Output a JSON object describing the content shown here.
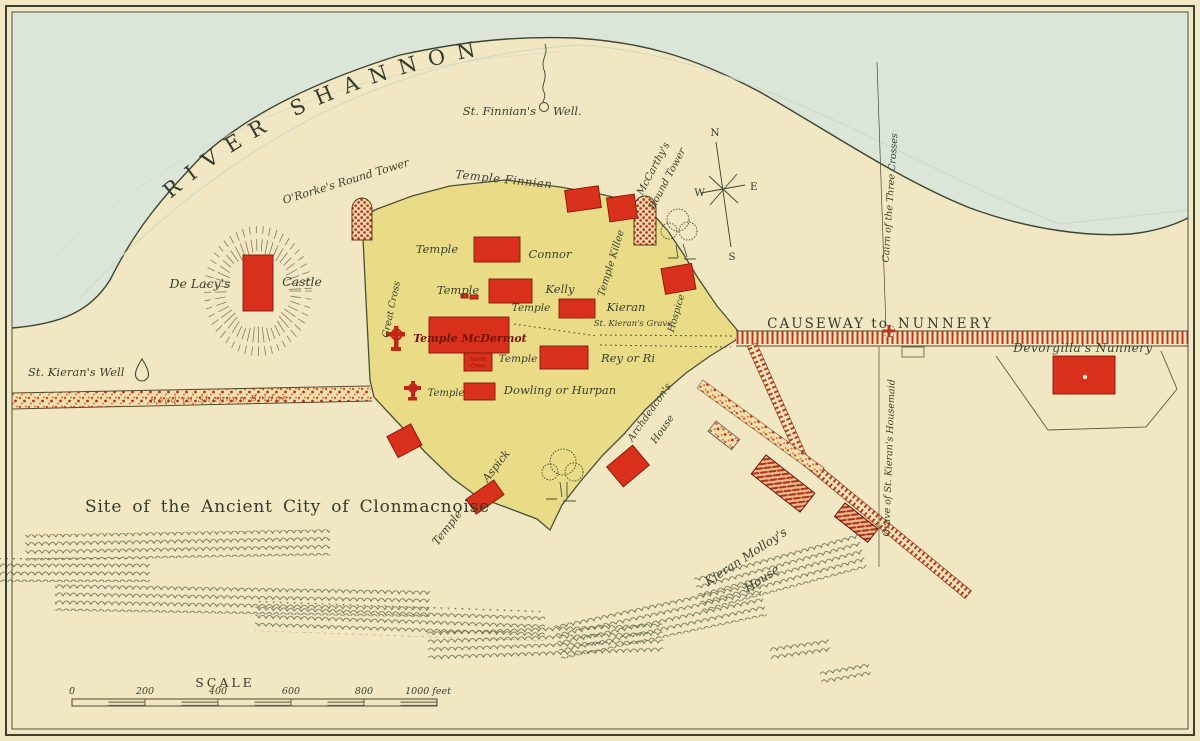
{
  "map": {
    "labels": {
      "river": "RIVER SHANNON",
      "finnians_well_a": "St. Finnian's",
      "finnians_well_b": "Well.",
      "ororkes_tower": "O'Rorke's Round Tower",
      "temple_finnian": "Temple Finnian",
      "mccarthys_tower_1": "McCarthy's",
      "mccarthys_tower_2": "Round Tower",
      "de_lacys": "De Lacy's",
      "castle": "Castle",
      "great_cross": "Great Cross",
      "temple_connor_a": "Temple",
      "temple_connor_b": "Connor",
      "temple_kelly_a": "Temple",
      "temple_kelly_b": "Kelly",
      "temple_kieran_a": "Temple",
      "temple_kieran_b": "Kieran",
      "st_kierans_grave": "St. Kieran's Grave",
      "temple_killee": "Temple Killee",
      "hospice": "Hospice",
      "temple_mcdermot": "Temple McDermot",
      "north_cross_a": "North",
      "north_cross_b": "Cross",
      "temple_rey_a": "Temple",
      "temple_rey_b": "Rey or Ri",
      "temple_dowling_a": "Temple",
      "temple_dowling_b": "Dowling or Hurpan",
      "temple_aspick_a": "Temple",
      "temple_aspick_b": "Aspick",
      "archdeacons_house_a": "Archdeacon's",
      "archdeacons_house_b": "House",
      "causeway_a": "CAUSEWAY to",
      "causeway_b": "NUNNERY",
      "cairn": "Cairn of the Three Crosses",
      "housemaid_grave": "Grave of St. Kieran's Housemaid",
      "devorgillas_nunnery": "Devorgilla's Nunnery",
      "kieran_molloys_a": "Kieran Molloy's",
      "kieran_molloys_b": "House",
      "st_kierans_well": "St. Kieran's Well",
      "old_road": "Road to Shannon Bridge",
      "site_title": "Site of the Ancient City of Clonmacnoise"
    },
    "compass": {
      "n": "N",
      "e": "E",
      "s": "S",
      "w": "W"
    },
    "scale": {
      "title": "SCALE",
      "ticks": [
        "0",
        "200",
        "400",
        "600",
        "800"
      ],
      "end_label": "1000 feet"
    },
    "colors": {
      "paper": "#f2e7c3",
      "river": "#dbe6d8",
      "enclosure": "#eadc87",
      "building_red": "#d8301b",
      "ink": "#3c4434",
      "road_red": "#c23418"
    }
  }
}
